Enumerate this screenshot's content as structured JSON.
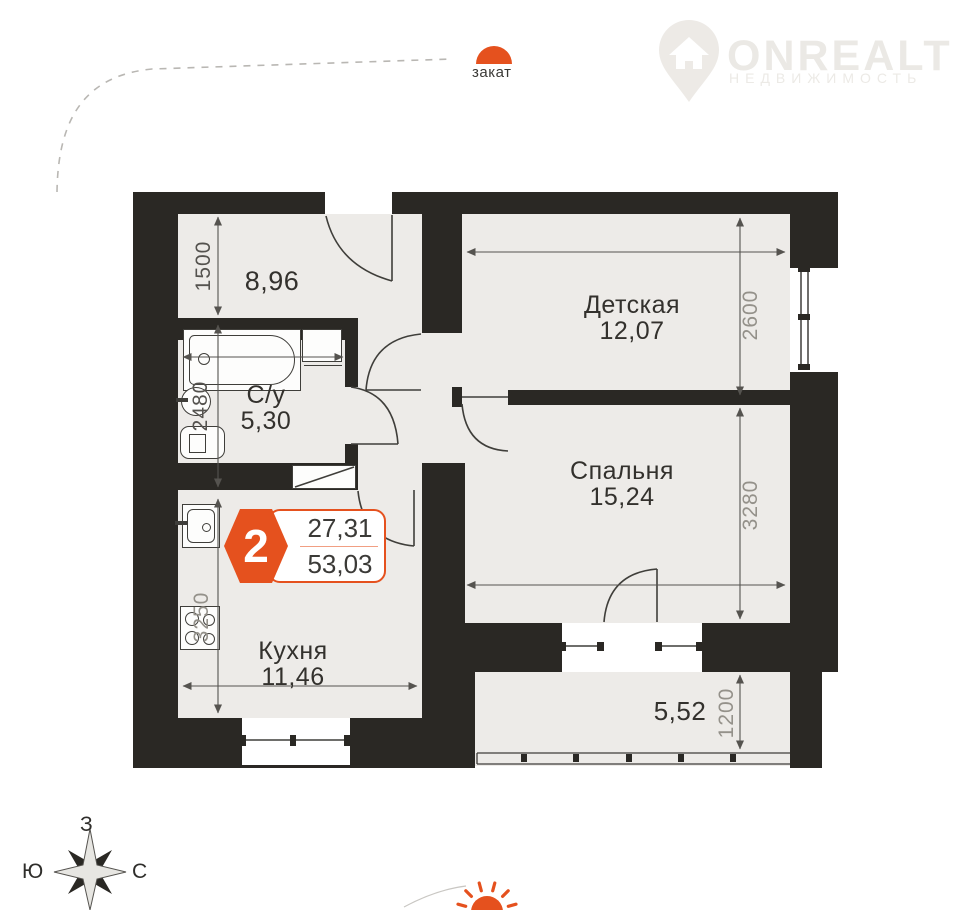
{
  "header": {
    "logo_text": "ONREALT",
    "logo_subtext": "НЕДВИЖИМОСТЬ"
  },
  "sun": {
    "sunset_label": "закат"
  },
  "badge": {
    "rooms": "2",
    "upper_area": "27,31",
    "lower_area": "53,03"
  },
  "rooms": {
    "hall": {
      "area": "8,96"
    },
    "bathroom": {
      "name": "С/у",
      "area": "5,30"
    },
    "kids": {
      "name": "Детская",
      "area": "12,07"
    },
    "bedroom": {
      "name": "Спальня",
      "area": "15,24"
    },
    "kitchen": {
      "name": "Кухня",
      "area": "11,46"
    },
    "balcony": {
      "area": "5,52"
    }
  },
  "dimensions": {
    "hall": "1500",
    "bathroom": "2480",
    "kitchen": "3250",
    "kids": "2600",
    "bedroom": "3280",
    "balcony": "1200"
  },
  "compass": {
    "west": "З",
    "south": "Ю",
    "north": "С"
  },
  "colors": {
    "accent": "#e5511e",
    "wall": "#2a2824",
    "floor": "#edebe8"
  }
}
